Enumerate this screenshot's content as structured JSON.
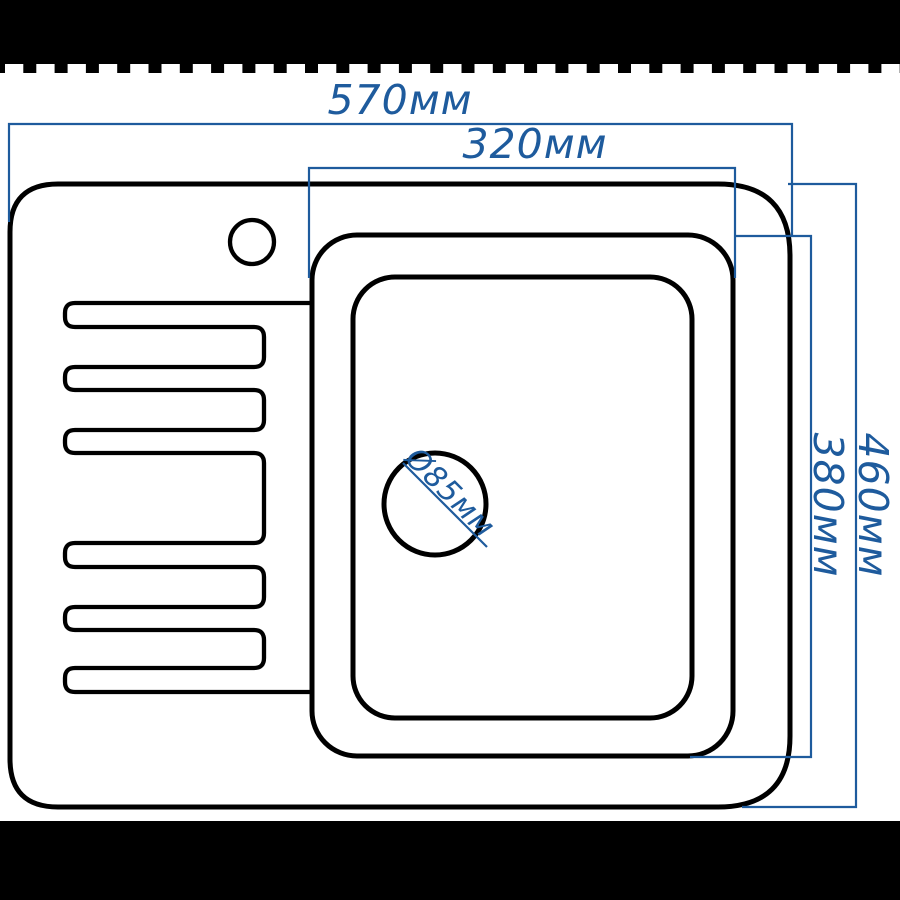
{
  "dimensions": {
    "overall_width": "570мм",
    "bowl_width": "320мм",
    "overall_depth": "460мм",
    "bowl_depth": "380мм",
    "drain_diameter": "Ø85мм"
  },
  "colors": {
    "dimension_blue": "#1e5b9d",
    "outline_black": "#000000",
    "frame_black": "#000000",
    "background": "#ffffff"
  }
}
